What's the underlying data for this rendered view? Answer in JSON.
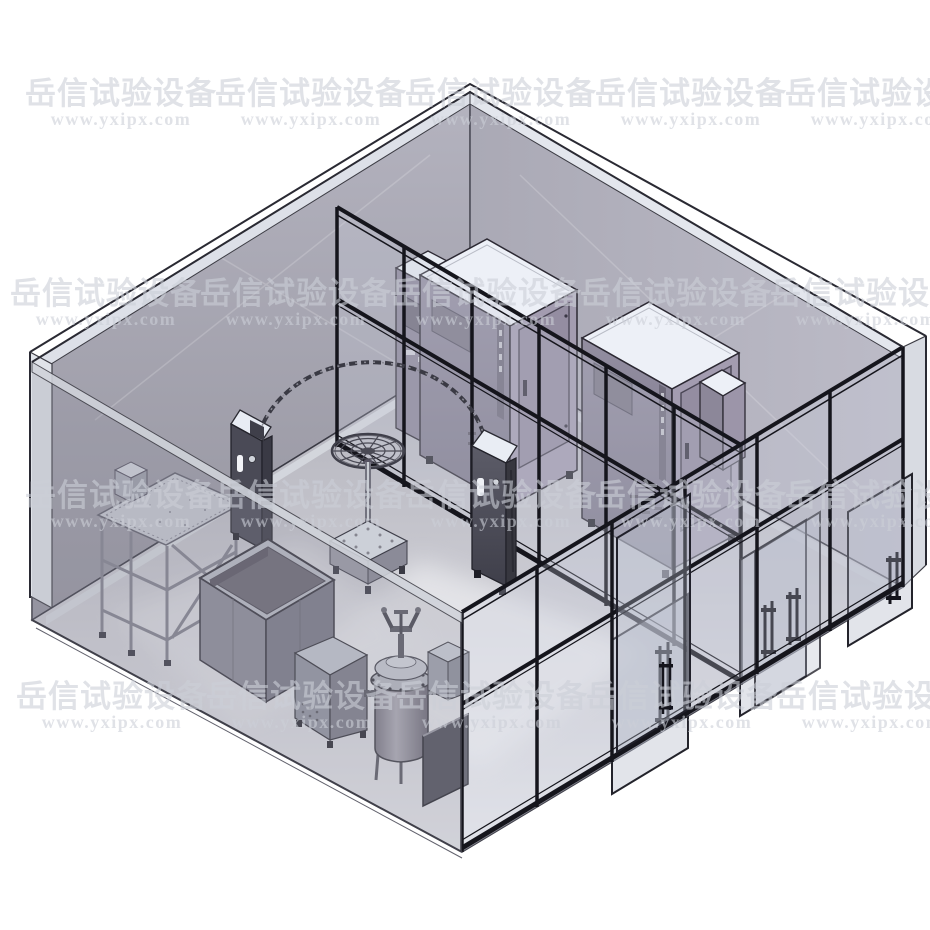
{
  "watermark": {
    "text": "岳信试验设备",
    "url": "www.yxipx.com",
    "url_dy": 21,
    "rows": [
      {
        "y": 104,
        "centers": [
          121,
          311,
          501,
          691,
          881
        ]
      },
      {
        "y": 304,
        "centers": [
          106,
          296,
          486,
          676,
          866
        ]
      },
      {
        "y": 506,
        "centers": [
          121,
          311,
          501,
          691,
          881
        ]
      },
      {
        "y": 707,
        "centers": [
          112,
          302,
          492,
          682,
          872
        ]
      }
    ]
  },
  "palette": {
    "bg": "#ffffff",
    "wall": "#a7a6b2",
    "frame": "#15151c",
    "glass": "rgba(200,205,218,0.28)",
    "doorGlass": "rgba(186,191,206,0.42)",
    "topWhite": "#edf0f7",
    "wm": "rgba(204,206,215,0.60)"
  },
  "equipment": [
    {
      "id": "glass-enclosure",
      "label": "Walk-in glass test room"
    },
    {
      "id": "glass-partition",
      "label": "Aluminium-framed glass partition"
    },
    {
      "id": "glass-wall-with-doors",
      "label": "Framed glass wall with sliding doors"
    },
    {
      "id": "sliding-doors",
      "label": "Sliding glass doors with bar handles"
    },
    {
      "id": "environmental-chamber-1",
      "label": "Environmental test chamber"
    },
    {
      "id": "environmental-chamber-2",
      "label": "Environmental test chamber"
    },
    {
      "id": "environmental-chamber-3",
      "label": "Environmental test chamber (partially hidden)"
    },
    {
      "id": "rear-control-cabinet",
      "label": "Control cabinet"
    },
    {
      "id": "oscillating-tube",
      "label": "Oscillating-tube rain test arc"
    },
    {
      "id": "turntable",
      "label": "Rotating sample turntable on pedestal"
    },
    {
      "id": "control-tower-left",
      "label": "Control console"
    },
    {
      "id": "control-tower-right",
      "label": "Control console"
    },
    {
      "id": "drip-test-stand",
      "label": "Drip test stand with perforated plate"
    },
    {
      "id": "water-tank",
      "label": "Open-top water tank"
    },
    {
      "id": "floor-cabinet",
      "label": "Control cabinet"
    },
    {
      "id": "pressure-vessel",
      "label": "Pressure immersion test vessel"
    },
    {
      "id": "pump-box",
      "label": "Pump box"
    },
    {
      "id": "equipment-panel",
      "label": "Equipment panel"
    }
  ]
}
